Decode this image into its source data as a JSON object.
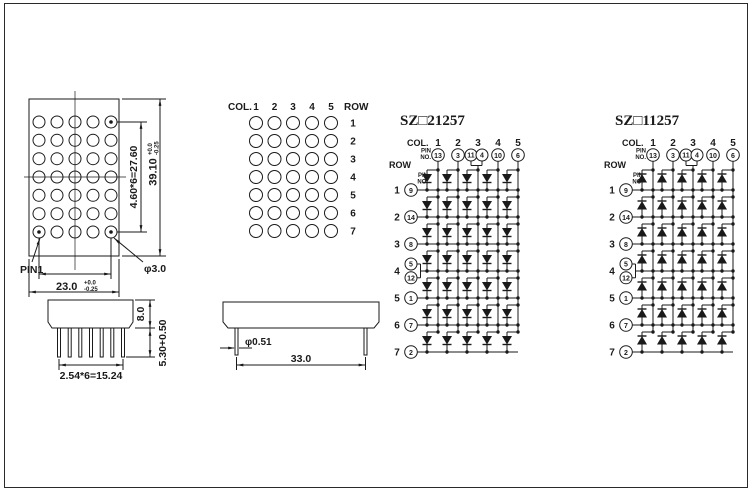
{
  "colors": {
    "ink": "#1a1a1a",
    "background": "#ffffff"
  },
  "front_view": {
    "pin1_label": "PIN1",
    "dim_col_pitch": "4.60*6=27.60",
    "dim_height": "39.10",
    "dim_height_tol_plus": "+0.0",
    "dim_height_tol_minus": "-0.25",
    "dim_width": "23.0",
    "dim_width_tol_plus": "+0.0",
    "dim_width_tol_minus": "-0.25",
    "hole_diameter": "φ3.0"
  },
  "matrix_view": {
    "col_label": "COL.",
    "row_label": "ROW",
    "col_numbers": [
      "1",
      "2",
      "3",
      "4",
      "5"
    ],
    "row_numbers": [
      "1",
      "2",
      "3",
      "4",
      "5",
      "6",
      "7"
    ]
  },
  "side_view": {
    "dim_body_height": "8.0",
    "dim_pin_length": "5.30+0.50",
    "dim_pin_pitch": "2.54*6=15.24"
  },
  "bottom_view": {
    "dim_pin_diameter": "φ0.51",
    "dim_body_width": "33.0"
  },
  "schematics": [
    {
      "title": "SZ□21257",
      "diode_direction": "down",
      "col_label": "COL.",
      "row_label": "ROW",
      "pin_no_label": [
        "PIN",
        "NO."
      ],
      "columns": [
        {
          "number": "1",
          "pins": [
            "13"
          ]
        },
        {
          "number": "2",
          "pins": [
            "3"
          ]
        },
        {
          "number": "3",
          "pins": [
            "11",
            "4"
          ]
        },
        {
          "number": "4",
          "pins": [
            "10"
          ]
        },
        {
          "number": "5",
          "pins": [
            "6"
          ]
        }
      ],
      "rows": [
        {
          "number": "1",
          "pins": [
            "9"
          ]
        },
        {
          "number": "2",
          "pins": [
            "14"
          ]
        },
        {
          "number": "3",
          "pins": [
            "8"
          ]
        },
        {
          "number": "4",
          "pins": [
            "5",
            "12"
          ]
        },
        {
          "number": "5",
          "pins": [
            "1"
          ]
        },
        {
          "number": "6",
          "pins": [
            "7"
          ]
        },
        {
          "number": "7",
          "pins": [
            "2"
          ]
        }
      ]
    },
    {
      "title": "SZ□11257",
      "diode_direction": "up",
      "col_label": "COL.",
      "row_label": "ROW",
      "pin_no_label": [
        "PIN",
        "NO."
      ],
      "columns": [
        {
          "number": "1",
          "pins": [
            "13"
          ]
        },
        {
          "number": "2",
          "pins": [
            "3"
          ]
        },
        {
          "number": "3",
          "pins": [
            "11",
            "4"
          ]
        },
        {
          "number": "4",
          "pins": [
            "10"
          ]
        },
        {
          "number": "5",
          "pins": [
            "6"
          ]
        }
      ],
      "rows": [
        {
          "number": "1",
          "pins": [
            "9"
          ]
        },
        {
          "number": "2",
          "pins": [
            "14"
          ]
        },
        {
          "number": "3",
          "pins": [
            "8"
          ]
        },
        {
          "number": "4",
          "pins": [
            "5",
            "12"
          ]
        },
        {
          "number": "5",
          "pins": [
            "1"
          ]
        },
        {
          "number": "6",
          "pins": [
            "7"
          ]
        },
        {
          "number": "7",
          "pins": [
            "2"
          ]
        }
      ]
    }
  ]
}
